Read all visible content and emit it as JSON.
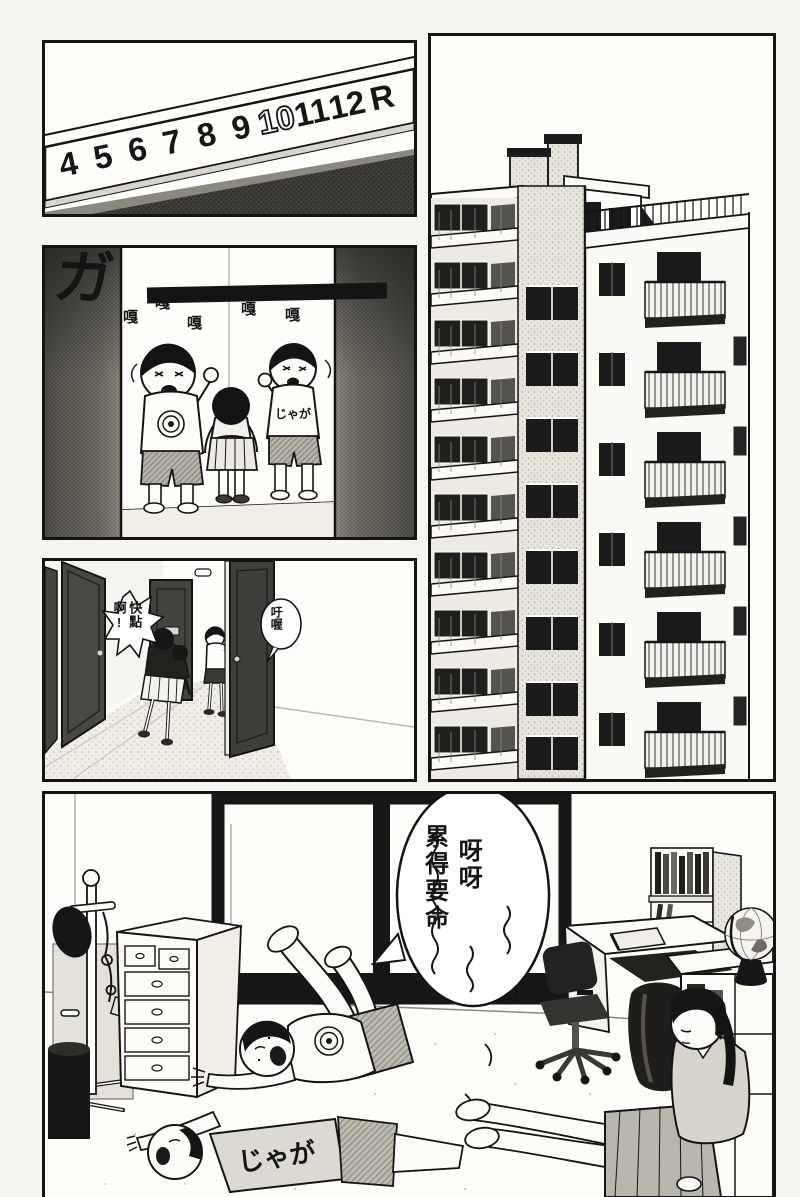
{
  "colors": {
    "ink": "#141414",
    "paper": "#f6f5f0",
    "panel_bg": "#fdfdf9",
    "door_dark": "#4a4843",
    "tone_light": "#e7e4db"
  },
  "panels": {
    "elevator_indicator": {
      "floors": [
        "4",
        "5",
        "6",
        "7",
        "8",
        "9",
        "10",
        "11",
        "12",
        "R"
      ],
      "lit_floor": "10"
    },
    "elevator_doors": {
      "sfx_big": "ガ",
      "sfx_rattles": [
        "嘎",
        "嘎",
        "嘎",
        "嘎",
        "嘎"
      ],
      "shirt_text": "じゃが"
    },
    "hallway": {
      "bubble_spiky": {
        "full_text": "快點啊!",
        "columns": [
          "快點",
          "啊!"
        ]
      },
      "bubble_round": {
        "full_text": "吁喔",
        "columns": [
          "吁喔"
        ]
      }
    },
    "room": {
      "bubble_tired": {
        "full_text": "呀呀～累得要命～～",
        "columns": [
          "呀呀",
          "累得要命"
        ]
      },
      "shirt_text": "じゃが"
    }
  }
}
